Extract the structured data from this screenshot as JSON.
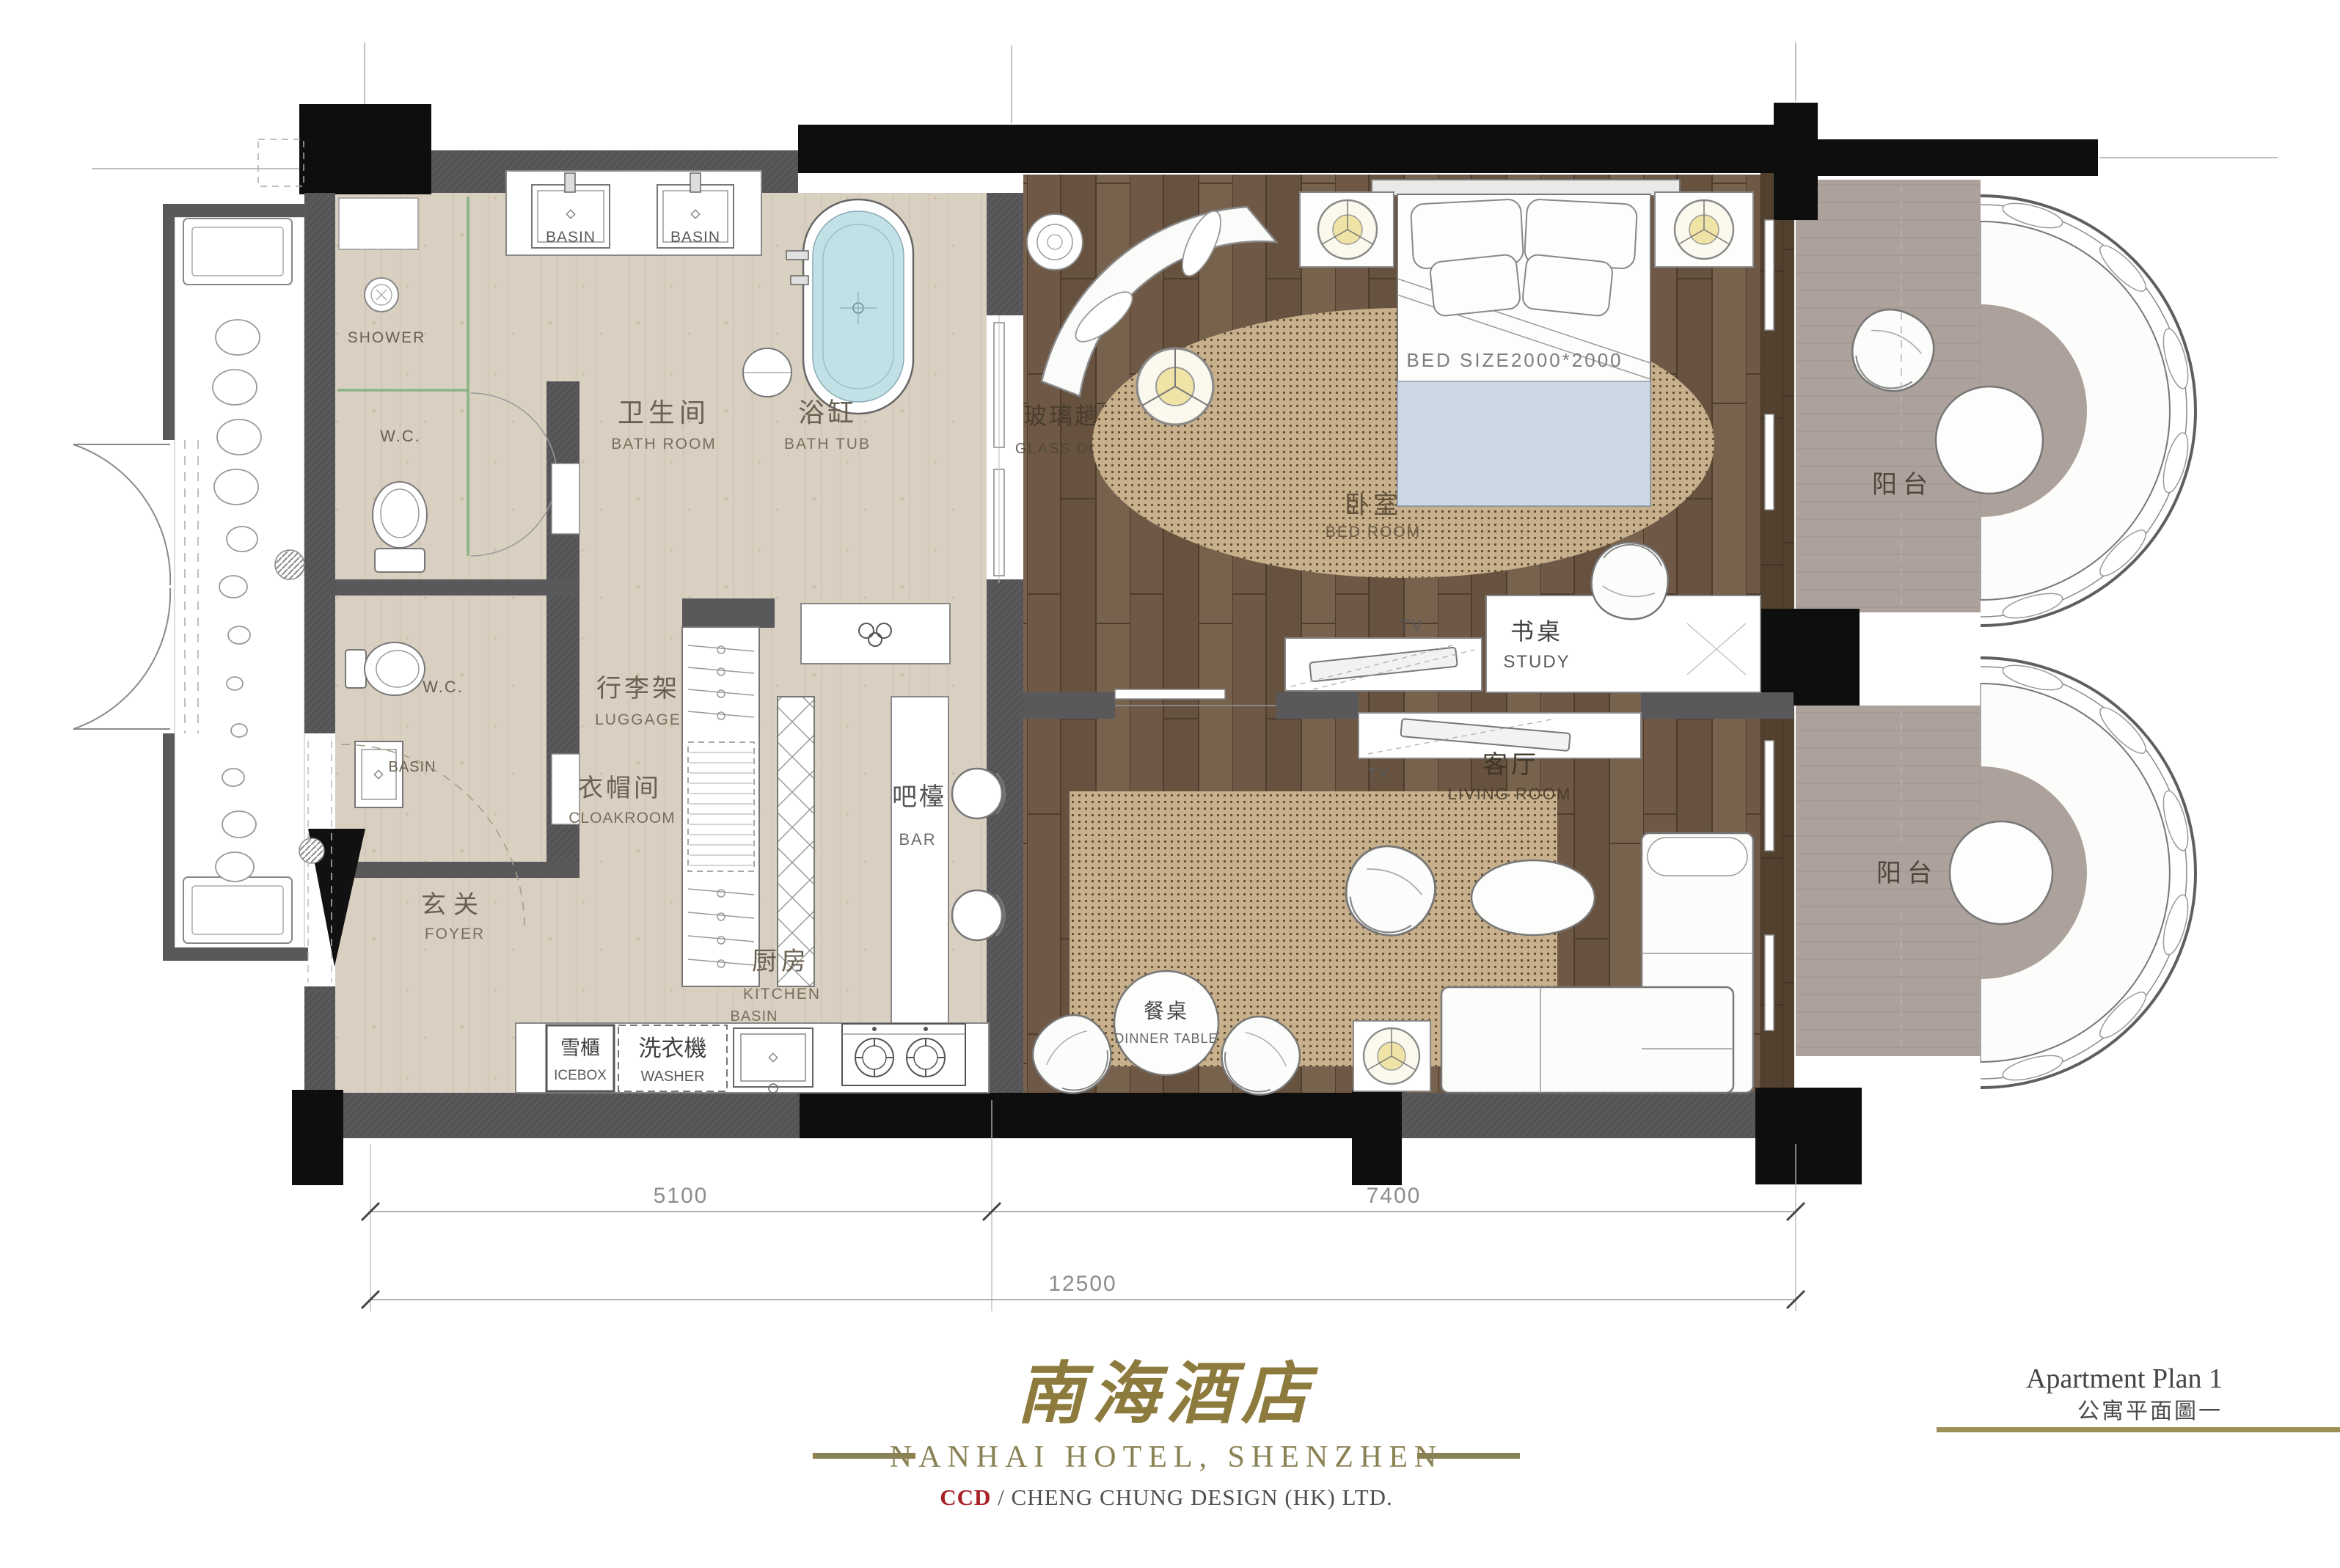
{
  "plan": {
    "rooms": {
      "bathroom": {
        "zh": "卫生间",
        "en": "BATH ROOM"
      },
      "bathtub": {
        "zh": "浴缸",
        "en": "BATH TUB"
      },
      "glass_door": {
        "zh": "玻璃趟門",
        "en": "GLASS DOOR"
      },
      "bedroom": {
        "zh": "卧室",
        "en": "BED ROOM"
      },
      "study": {
        "zh": "书桌",
        "en": "STUDY"
      },
      "living_room": {
        "zh": "客厅",
        "en": "LIVING ROOM"
      },
      "luggage": {
        "zh": "行李架",
        "en": "LUGGAGE"
      },
      "cloakroom": {
        "zh": "衣帽间",
        "en": "CLOAKROOM"
      },
      "bar": {
        "zh": "吧檯",
        "en": "BAR"
      },
      "foyer": {
        "zh": "玄关",
        "en": "FOYER"
      },
      "kitchen": {
        "zh": "厨房",
        "en": "KITCHEN"
      },
      "dinner_table": {
        "zh": "餐桌",
        "en": "DINNER TABLE"
      },
      "balcony_top": {
        "zh": "阳台"
      },
      "balcony_bottom": {
        "zh": "阳台"
      },
      "icebox": {
        "zh": "雪櫃",
        "en": "ICEBOX"
      },
      "washer": {
        "zh": "洗衣機",
        "en": "WASHER"
      }
    },
    "fixtures": {
      "basin_left": "BASIN",
      "basin_right": "BASIN",
      "basin_wc": "BASIN",
      "basin_kitchen": "BASIN",
      "shower": "SHOWER",
      "wc_upper": "W.C.",
      "wc_lower": "W.C.",
      "bed_size": "BED SIZE2000*2000",
      "tv_bedroom": "TV",
      "tv_living": "TV"
    },
    "dimensions": {
      "left": "5100",
      "right": "7400",
      "total": "12500"
    }
  },
  "footer": {
    "logo_zh": "南海酒店",
    "hotel_name": "NANHAI HOTEL, SHENZHEN",
    "firm_abbr": "CCD",
    "firm_rest": " / CHENG CHUNG DESIGN (HK) LTD.",
    "plan_title_en": "Apartment Plan 1",
    "plan_title_zh": "公寓平面圖一"
  },
  "colors": {
    "wall": "#59595b",
    "black": "#0e0e0e",
    "beige": "#d9d0c1",
    "wood": "#6b5644",
    "rug": "#c7b08b",
    "balcony": "#aca19b",
    "water": "#c2e1e6",
    "lamp": "#efe3a6",
    "gold": "#8a8254",
    "ccd_red": "#a82126"
  }
}
